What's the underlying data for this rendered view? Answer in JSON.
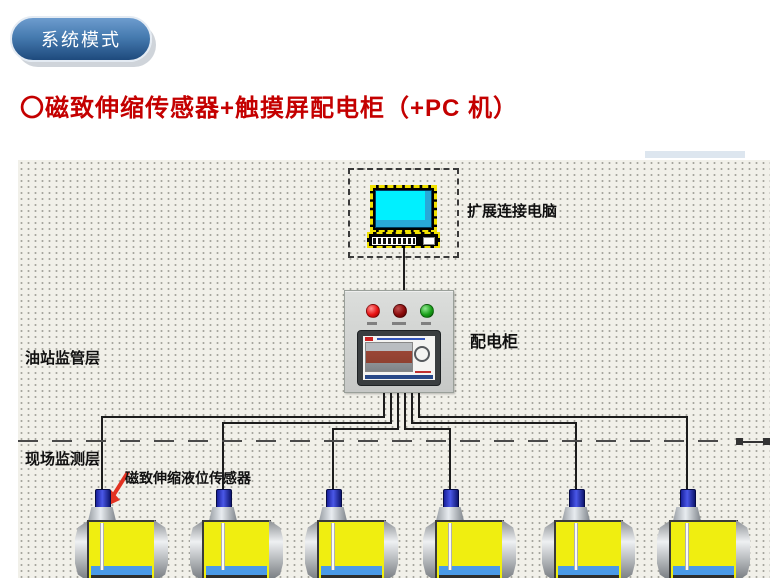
{
  "badge": {
    "label": "系统模式"
  },
  "heading": {
    "text": "〇磁致伸缩传感器+触摸屏配电柜（+PC 机）"
  },
  "diagram": {
    "pc_label": "扩展连接电脑",
    "cabinet_label": "配电柜",
    "supervision_layer_label": "油站监管层",
    "field_layer_label": "现场监测层",
    "sensor_label": "磁致伸缩液位传感器",
    "tank_count": 6
  },
  "colors": {
    "badge_blue_top": "#6d9cce",
    "badge_blue_bottom": "#1e4a7d",
    "heading_red": "#c40000",
    "panel_background": "#f1f0e9",
    "tank_fill_yellow": "#f0ee10",
    "water_strip_blue": "#4a9ae8",
    "sensor_blue": "#2a35c8",
    "indicator_red": "#e81212",
    "indicator_dark_red": "#8a0a0a",
    "indicator_green": "#18a018",
    "pc_screen_cyan": "#00f0ff",
    "arrow_red": "#e23222"
  }
}
